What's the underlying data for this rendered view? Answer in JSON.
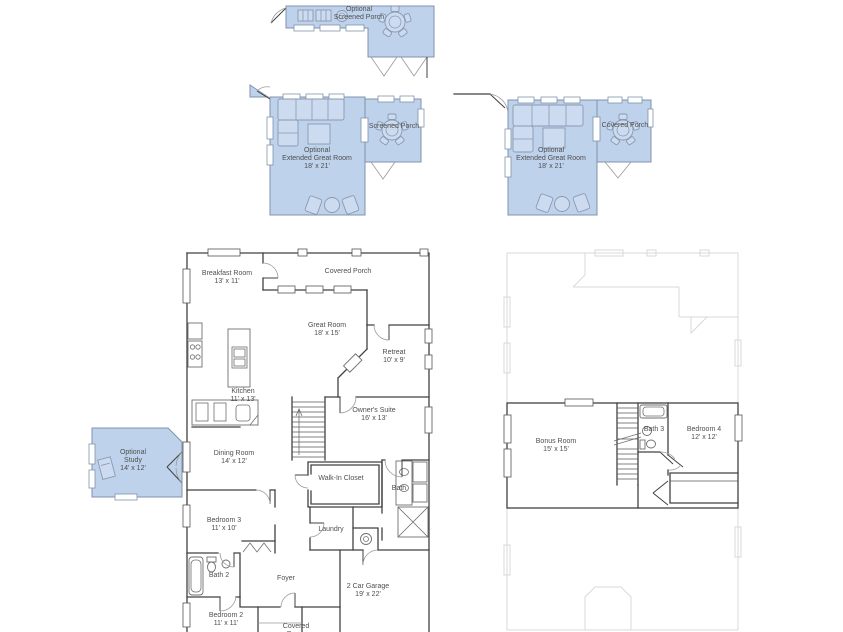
{
  "page": {
    "background": "#ffffff",
    "width": 843,
    "height": 632,
    "type": "floor-plan-drawing"
  },
  "colors": {
    "optional_area_fill": "#bed2ec",
    "optional_area_border": "#8093ab",
    "wall": "#414141",
    "ghost_wall": "#d9d9d9",
    "label_text": "#4f4f4f",
    "furniture_outline": "#8a9ab0"
  },
  "optional_areas": {
    "screened_porch_top": {
      "prefix": "Optional",
      "name": "Screened Porch"
    },
    "extended_great_room_left": {
      "prefix": "Optional",
      "name": "Extended Great Room",
      "dims": "18' x 21'"
    },
    "screened_porch_left": {
      "name": "Screened Porch"
    },
    "extended_great_room_right": {
      "prefix": "Optional",
      "name": "Extended Great Room",
      "dims": "18' x 21'"
    },
    "covered_porch_right": {
      "name": "Covered Porch"
    },
    "study": {
      "prefix": "Optional",
      "name": "Study",
      "dims": "14' x 12'"
    }
  },
  "first_floor": {
    "breakfast_room": {
      "name": "Breakfast Room",
      "dims": "13' x 11'"
    },
    "covered_porch": {
      "name": "Covered Porch"
    },
    "great_room": {
      "name": "Great Room",
      "dims": "18' x 15'"
    },
    "retreat": {
      "name": "Retreat",
      "dims": "10' x 9'"
    },
    "kitchen": {
      "name": "Kitchen",
      "dims": "11' x 13'"
    },
    "dining_room": {
      "name": "Dining Room",
      "dims": "14' x 12'"
    },
    "owners_suite": {
      "name": "Owner's Suite",
      "dims": "16' x 13'"
    },
    "walk_in_closet": {
      "name": "Walk-In Closet"
    },
    "bath": {
      "name": "Bath"
    },
    "bedroom_3": {
      "name": "Bedroom 3",
      "dims": "11' x 10'"
    },
    "laundry": {
      "name": "Laundry"
    },
    "bath_2": {
      "name": "Bath 2"
    },
    "foyer": {
      "name": "Foyer"
    },
    "bedroom_2": {
      "name": "Bedroom 2",
      "dims": "11' x 11'"
    },
    "front_porch": {
      "name": "Covered Porch"
    },
    "garage": {
      "name": "2 Car Garage",
      "dims": "19' x 22'"
    }
  },
  "second_floor": {
    "bonus_room": {
      "name": "Bonus Room",
      "dims": "15' x 15'"
    },
    "bath_3": {
      "name": "Bath 3"
    },
    "bedroom_4": {
      "name": "Bedroom 4",
      "dims": "12' x 12'"
    }
  }
}
